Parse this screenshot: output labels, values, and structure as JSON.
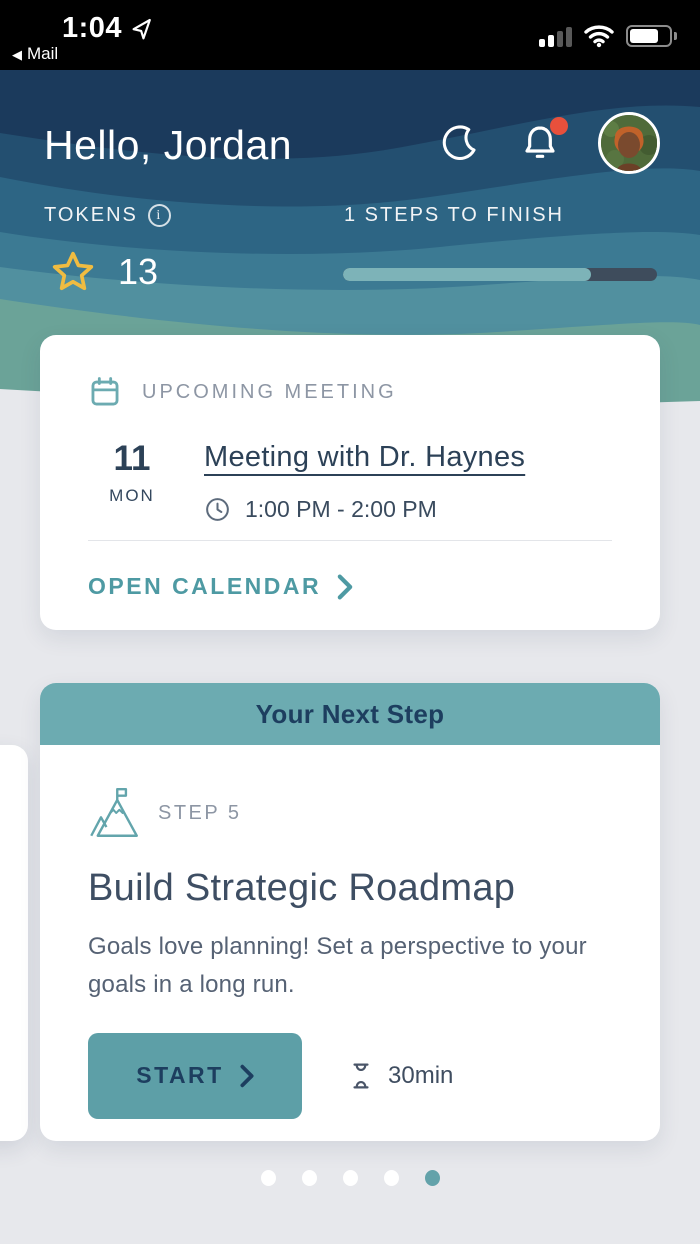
{
  "status_bar": {
    "time": "1:04",
    "back_app": "Mail",
    "back_glyph": "◀",
    "signal_bars_filled": 2,
    "signal_bars_total": 4,
    "battery_pct": 75,
    "icons": [
      "location-arrow-icon",
      "cellular-signal-icon",
      "wifi-icon",
      "battery-icon"
    ]
  },
  "header": {
    "greeting": "Hello, Jordan",
    "tokens_label": "TOKENS",
    "tokens_value": "13",
    "steps_label": "1 STEPS TO FINISH",
    "progress_pct": 79,
    "icons": [
      "moon-icon",
      "bell-icon",
      "avatar"
    ],
    "notification_badge": true
  },
  "meeting_card": {
    "label": "UPCOMING MEETING",
    "date_day": "11",
    "date_weekday": "MON",
    "title": "Meeting with Dr. Haynes",
    "time_range": "1:00 PM - 2:00 PM",
    "link_label": "OPEN CALENDAR"
  },
  "next_step_card": {
    "header": "Your Next Step",
    "step_label": "STEP 5",
    "title": "Build Strategic Roadmap",
    "description": "Goals love planning! Set a perspective to your goals in a long run.",
    "start_label": "START",
    "duration": "30min"
  },
  "carousel": {
    "dots": 5,
    "active_index": 4
  },
  "colors": {
    "accent_teal": "#5d9fa7",
    "header_teal": "#6cabb1",
    "navy_text": "#1d3e5f",
    "gold_star": "#f0bc41",
    "badge_red": "#e8503c",
    "progress_fill": "#7db3b8",
    "progress_track": "#3e4c5c",
    "page_bg": "#e7e8ec",
    "wave_colors": [
      "#1b3a5c",
      "#234f70",
      "#2d6584",
      "#3c7a93",
      "#51909f",
      "#6ba398"
    ]
  }
}
